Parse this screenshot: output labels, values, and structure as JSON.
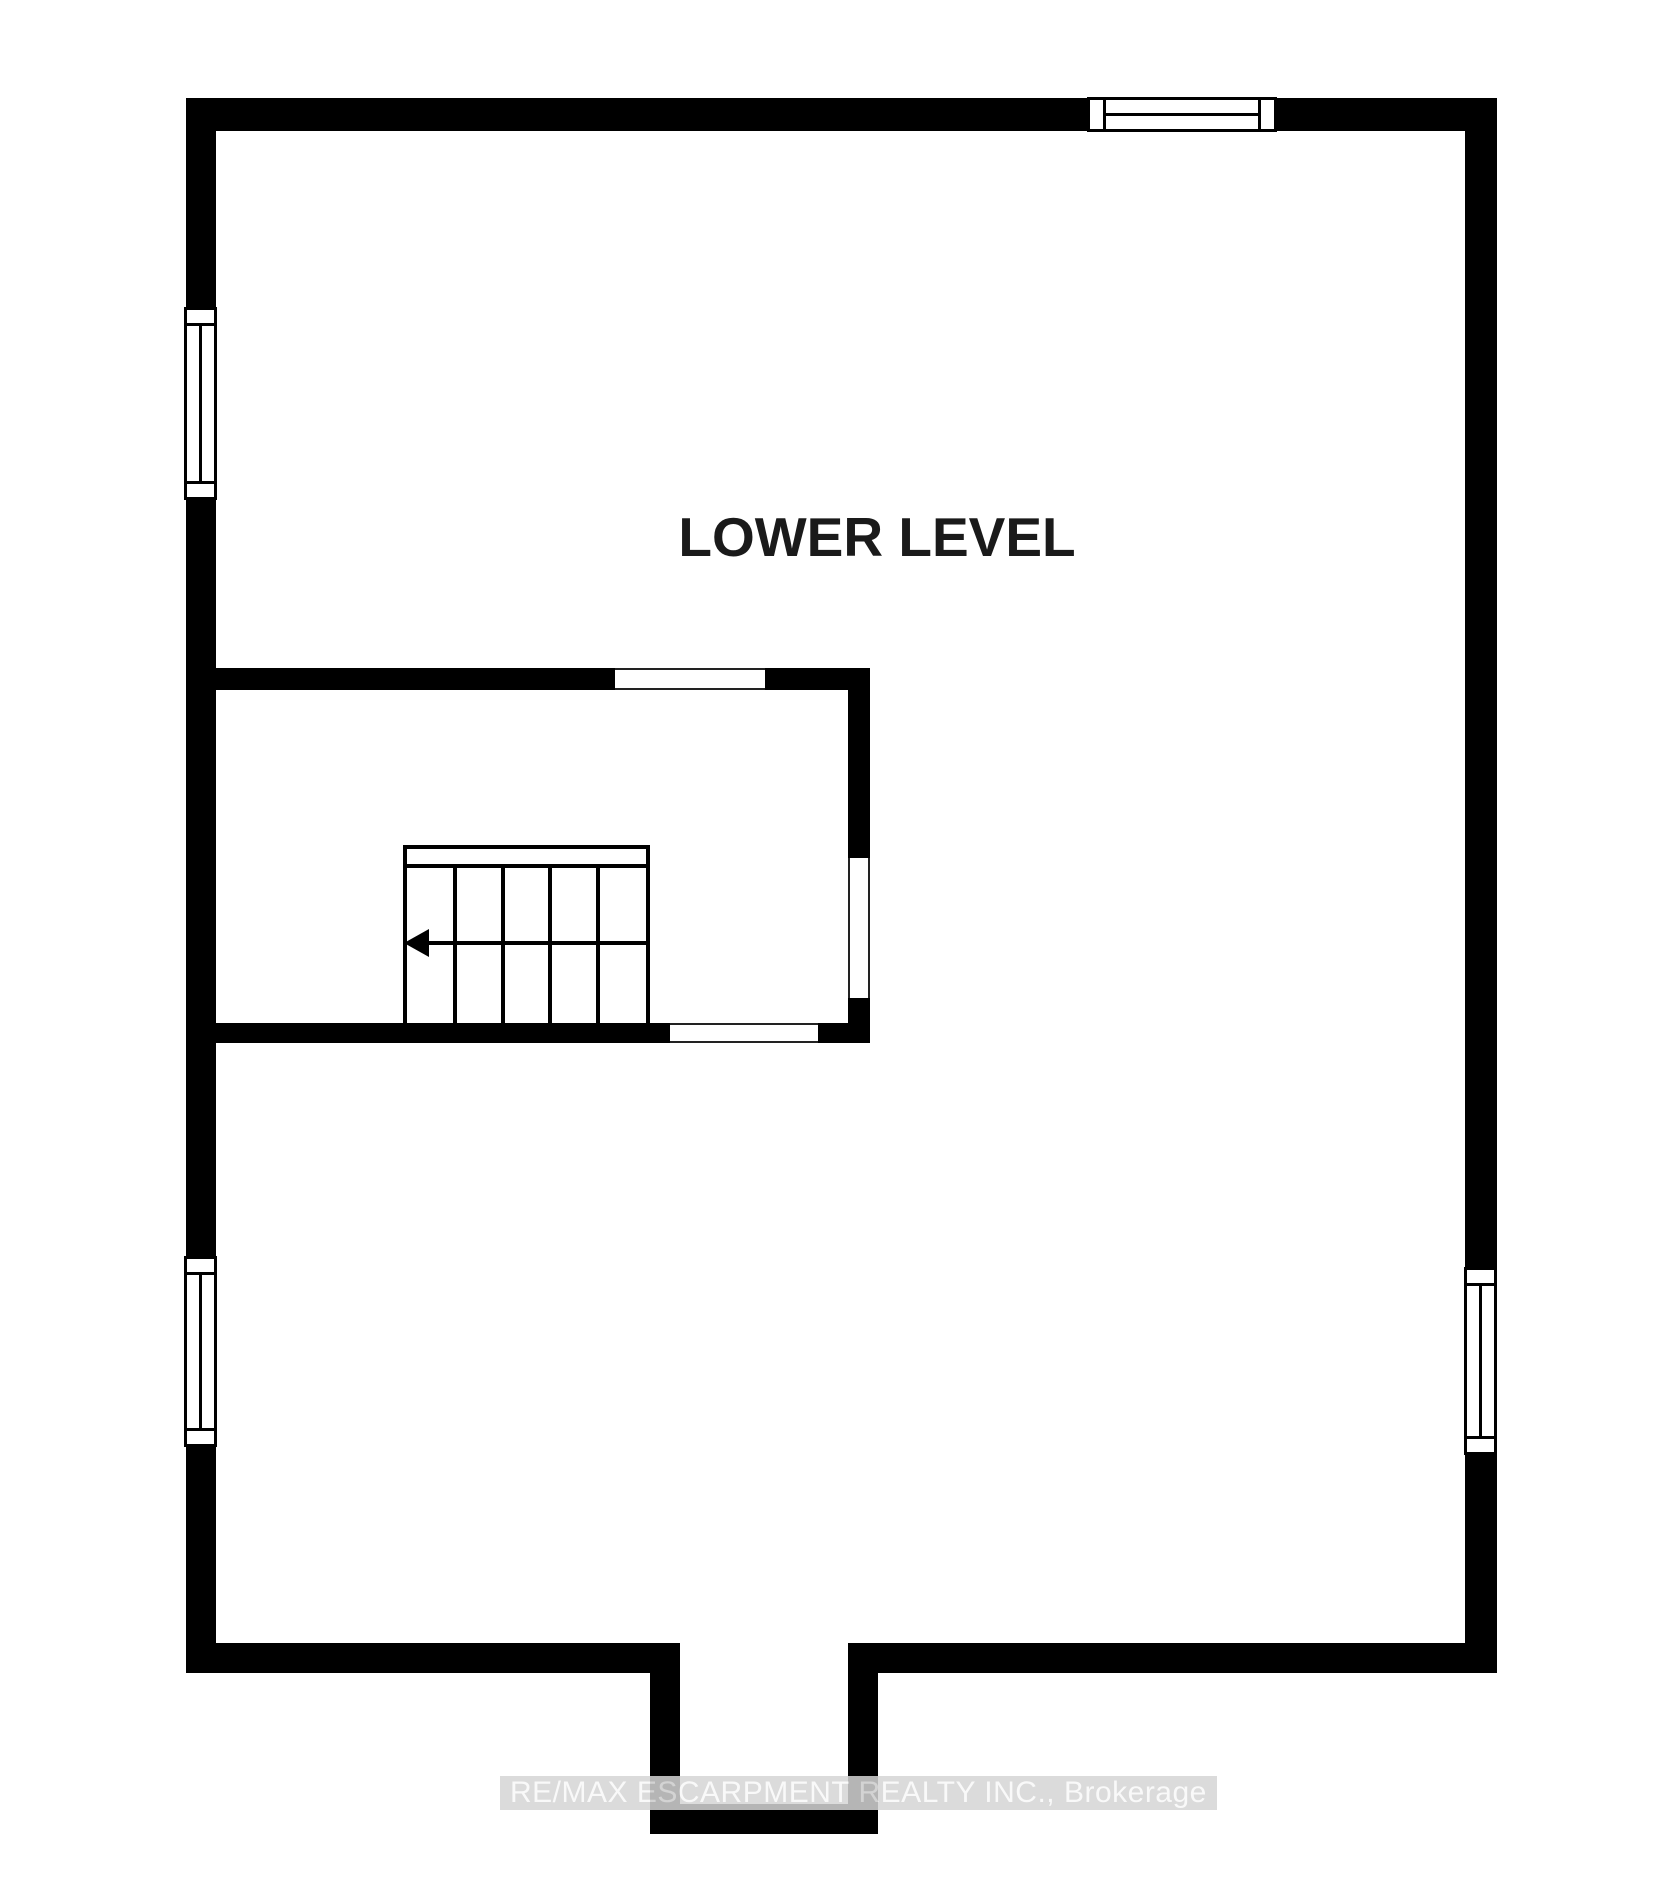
{
  "floor_plan": {
    "level_label": "LOWER LEVEL",
    "watermark_text": "RE/MAX ESCARPMENT REALTY INC., Brokerage",
    "colors": {
      "wall": "#000000",
      "floor": "#ffffff",
      "opening_line": "#222222",
      "label_text": "#1a1a1a",
      "watermark_text": "#f8f8f8",
      "watermark_band": "#d5d5d5"
    },
    "stairs": {
      "tread_count": 5,
      "direction_arrow": "left"
    },
    "windows": [
      {
        "id": "top-wall-window",
        "wall": "top"
      },
      {
        "id": "left-wall-upper-window",
        "wall": "left"
      },
      {
        "id": "left-wall-lower-window",
        "wall": "left"
      },
      {
        "id": "right-wall-window",
        "wall": "right"
      }
    ],
    "openings": [
      {
        "id": "stairwell-top-opening"
      },
      {
        "id": "stairwell-right-opening"
      },
      {
        "id": "stairwell-bottom-opening"
      }
    ]
  }
}
